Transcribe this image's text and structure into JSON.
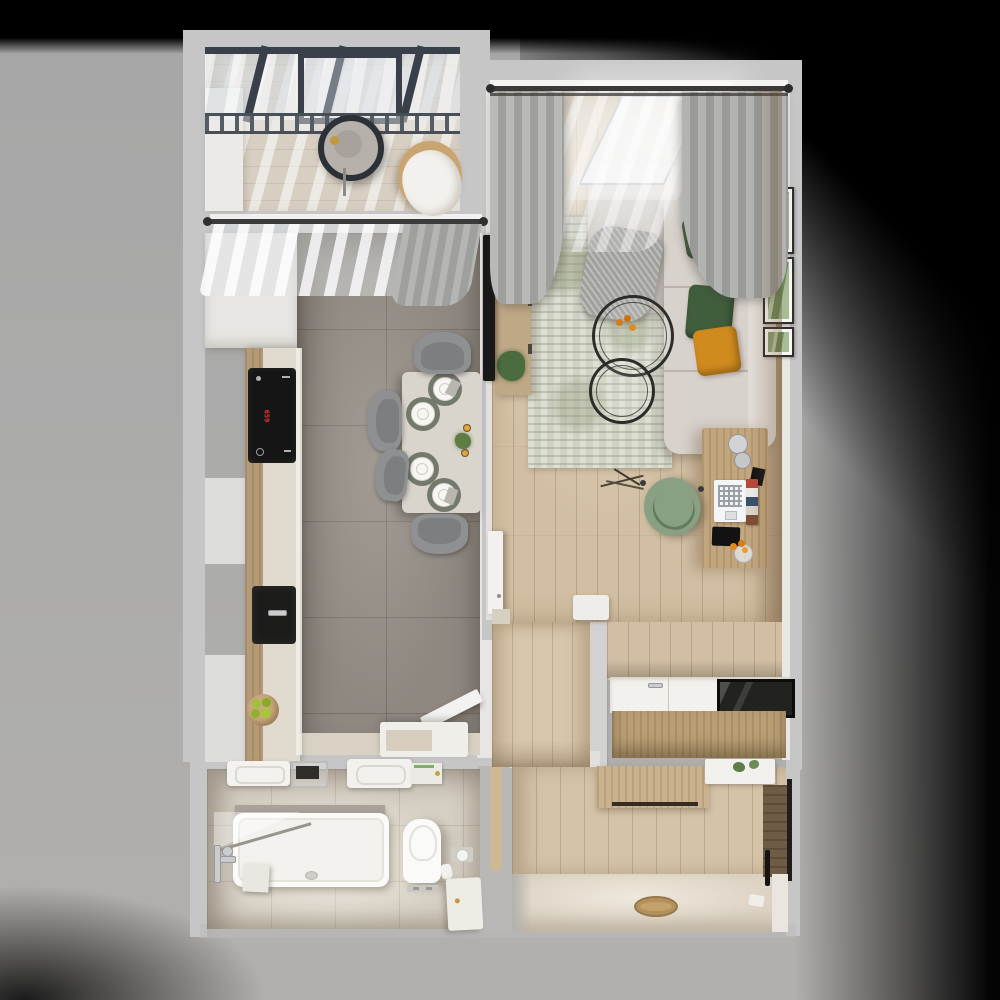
{
  "meta": {
    "title": "Apartment floor plan — top-down 3D render",
    "render_type": "photorealistic floorplan",
    "visible_text": "659"
  },
  "palette": {
    "backdrop_gray": "#ababab",
    "vignette_black": "#000000",
    "wall_gray": "#c6c6c7",
    "wall_inner_white": "#e9e7e3",
    "oak_floor": "#d2bfa3",
    "kitchen_tile": "#8f8881",
    "bath_tile": "#d6cfc3",
    "sofa_beige": "#d8d2cc",
    "pillow_orange": "#d08a22",
    "pillow_green": "#45603e",
    "chair_sage": "#89a083",
    "rug_sage": "#d0d2c4",
    "pergola_frame": "#39404a",
    "wood_cabinet": "#bfa886",
    "cooktop_display_red": "#e8392b"
  },
  "rooms": [
    {
      "name": "balcony",
      "furniture": [
        "glass-pergola-roof",
        "railing",
        "hanging-egg-chair",
        "rattan-lounge-chair"
      ]
    },
    {
      "name": "kitchen",
      "cooktop_display": "659",
      "furniture": [
        "sheer-curtain",
        "gray-drape",
        "tall-cabinet",
        "counter-run",
        "induction-cooktop",
        "black-sink",
        "fruit-bowl",
        "dining-table",
        "place-settings-x4",
        "candles",
        "table-plant",
        "gray-chairs-x4",
        "open-door",
        "open-shelf-unit"
      ]
    },
    {
      "name": "living-room",
      "furniture": [
        "double-curtain-rod",
        "gray-drapes",
        "sheer-curtain",
        "corner-sofa",
        "throw-blanket",
        "orange-pillows",
        "green-pillows",
        "area-rug",
        "nesting-coffee-tables",
        "flower-decor",
        "tv",
        "tv-console",
        "plant",
        "wall-frames-x3",
        "desk",
        "desk-lamp",
        "laptop",
        "books",
        "tablet",
        "flower-vase",
        "sage-office-chair",
        "white-bench",
        "open-door"
      ]
    },
    {
      "name": "wardrobe-niche",
      "furniture": [
        "built-in-wardrobe",
        "glass-top-section"
      ]
    },
    {
      "name": "hallway",
      "furniture": [
        "shoe-cabinet",
        "floating-shelf",
        "plant",
        "entry-door",
        "round-door-mat"
      ]
    },
    {
      "name": "bathroom",
      "furniture": [
        "washbasin",
        "towel-rack",
        "second-washbasin",
        "mirror-cabinet",
        "stone-ledge",
        "bathtub",
        "glass-screen",
        "shower-set",
        "toilet",
        "flush-plate",
        "toilet-paper-holder",
        "spare-roll",
        "side-cabinet"
      ]
    }
  ]
}
